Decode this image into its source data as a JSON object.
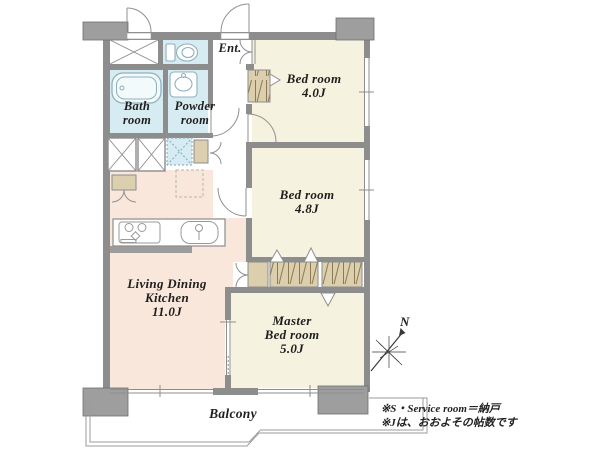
{
  "floorplan": {
    "rooms": {
      "bath": {
        "lines": [
          "Bath",
          "room"
        ]
      },
      "powder": {
        "lines": [
          "Powder",
          "room"
        ]
      },
      "entrance": {
        "label": "Ent."
      },
      "bedroom1": {
        "lines": [
          "Bed room",
          "4.0J"
        ]
      },
      "bedroom2": {
        "lines": [
          "Bed room",
          "4.8J"
        ]
      },
      "ldk": {
        "lines": [
          "Living Dining",
          "Kitchen",
          "11.0J"
        ]
      },
      "master": {
        "lines": [
          "Master",
          "Bed room",
          "5.0J"
        ]
      },
      "balcony": {
        "label": "Balcony"
      }
    },
    "compass": {
      "label": "N"
    },
    "notes": {
      "line1": "※S・Service room＝納戸",
      "line2": "※Jは、おおよその帖数です"
    },
    "colors": {
      "wall": "#8d8d8d",
      "pillar": "#9e9e9e",
      "wet_room": "#d7ecf2",
      "bedroom": "#f5f3df",
      "ldk": "#f9e7dc",
      "closet": "#dccfae",
      "fixture_outline": "#8fb0bd"
    }
  }
}
